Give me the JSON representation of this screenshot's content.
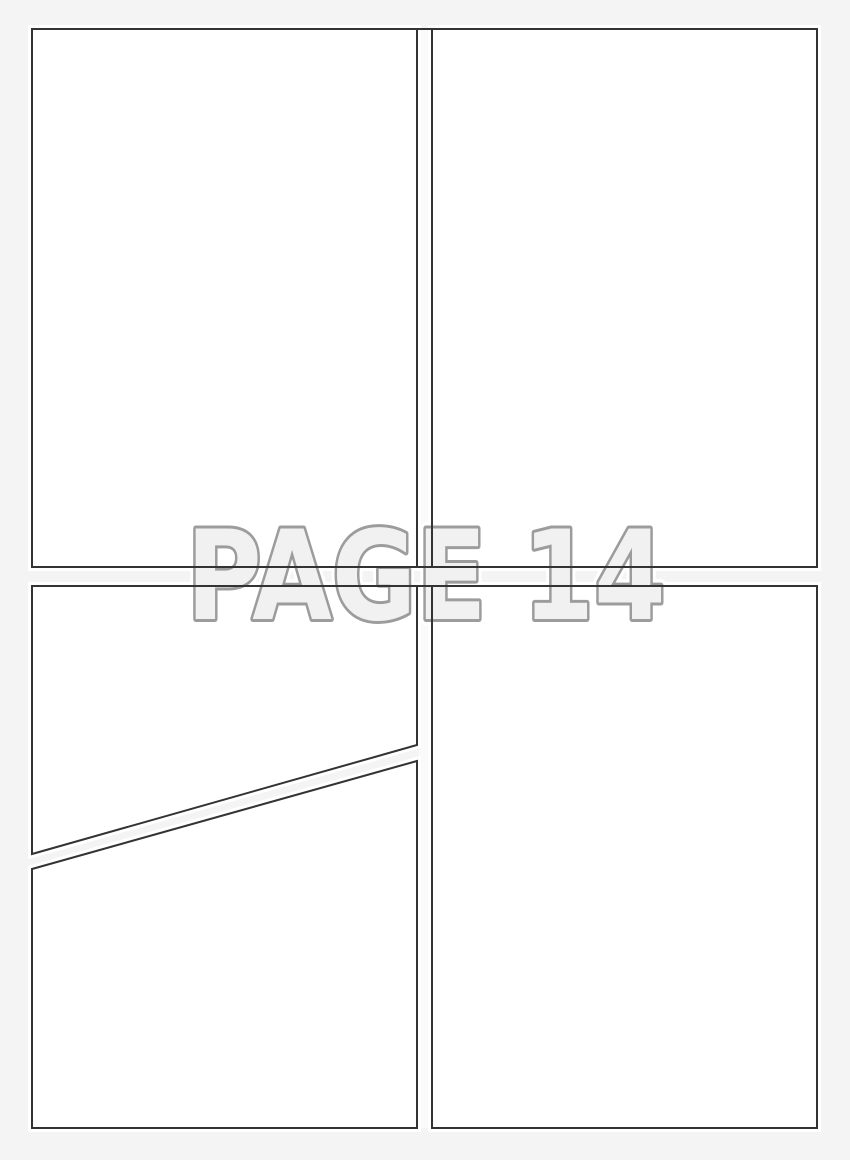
{
  "watermark": {
    "text": "PAGE 14"
  },
  "colors": {
    "page_bg": "#f4f4f4",
    "panel_fill": "#ffffff",
    "panel_glow": "#ffffff",
    "panel_border": "#333333",
    "gutter_fill": "#fafafa",
    "watermark_fill": "#f1f1f1",
    "watermark_stroke": "#9c9c9c",
    "watermark_halo": "#ffffff"
  }
}
